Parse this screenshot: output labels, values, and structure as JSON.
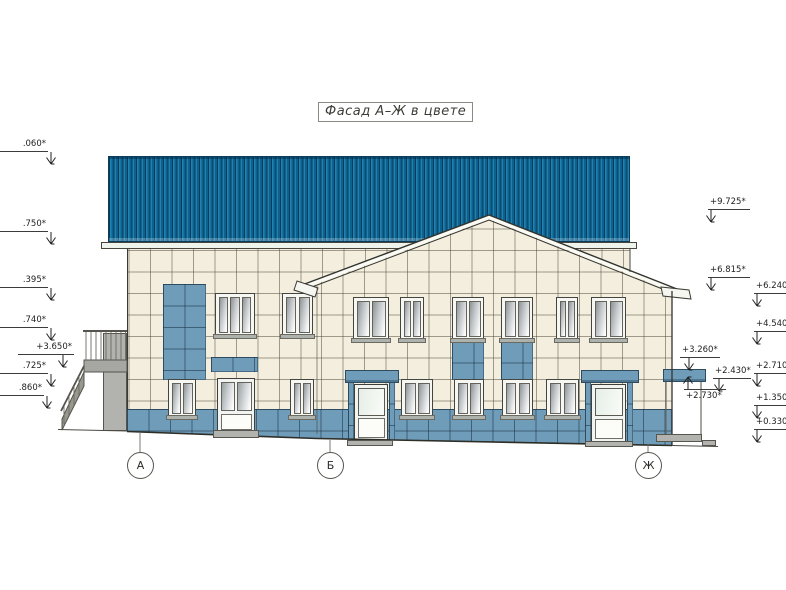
{
  "title": {
    "label": "Фасад А–Ж в цвете"
  },
  "axis_labels": [
    {
      "label": "А"
    },
    {
      "label": "Б"
    },
    {
      "label": "Ж"
    }
  ],
  "elevation_marks": {
    "left": [
      {
        "label": ".060*"
      },
      {
        "label": ".750*"
      },
      {
        "label": ".395*"
      },
      {
        "label": ".740*"
      },
      {
        "label": "+3.650*"
      },
      {
        "label": ".725*"
      },
      {
        "label": ".860*"
      }
    ],
    "right": [
      {
        "label": "+9.725*"
      },
      {
        "label": "+6.815*"
      },
      {
        "label": "+6.240*"
      },
      {
        "label": "+4.540*"
      },
      {
        "label": "+3.260*"
      },
      {
        "label": "+2.430*"
      },
      {
        "label": "+2.710*"
      },
      {
        "label": "+2.730*"
      },
      {
        "label": "+1.350*"
      },
      {
        "label": "+0.330*"
      }
    ]
  },
  "colors": {
    "roof_blue": "#1477a6",
    "accent_blue": "#6f9cb8",
    "wall_cream": "#f3eede",
    "fascia_white": "#eef3ec",
    "concrete_gray": "#b2b2ae",
    "line_dark": "#3a3a34"
  }
}
